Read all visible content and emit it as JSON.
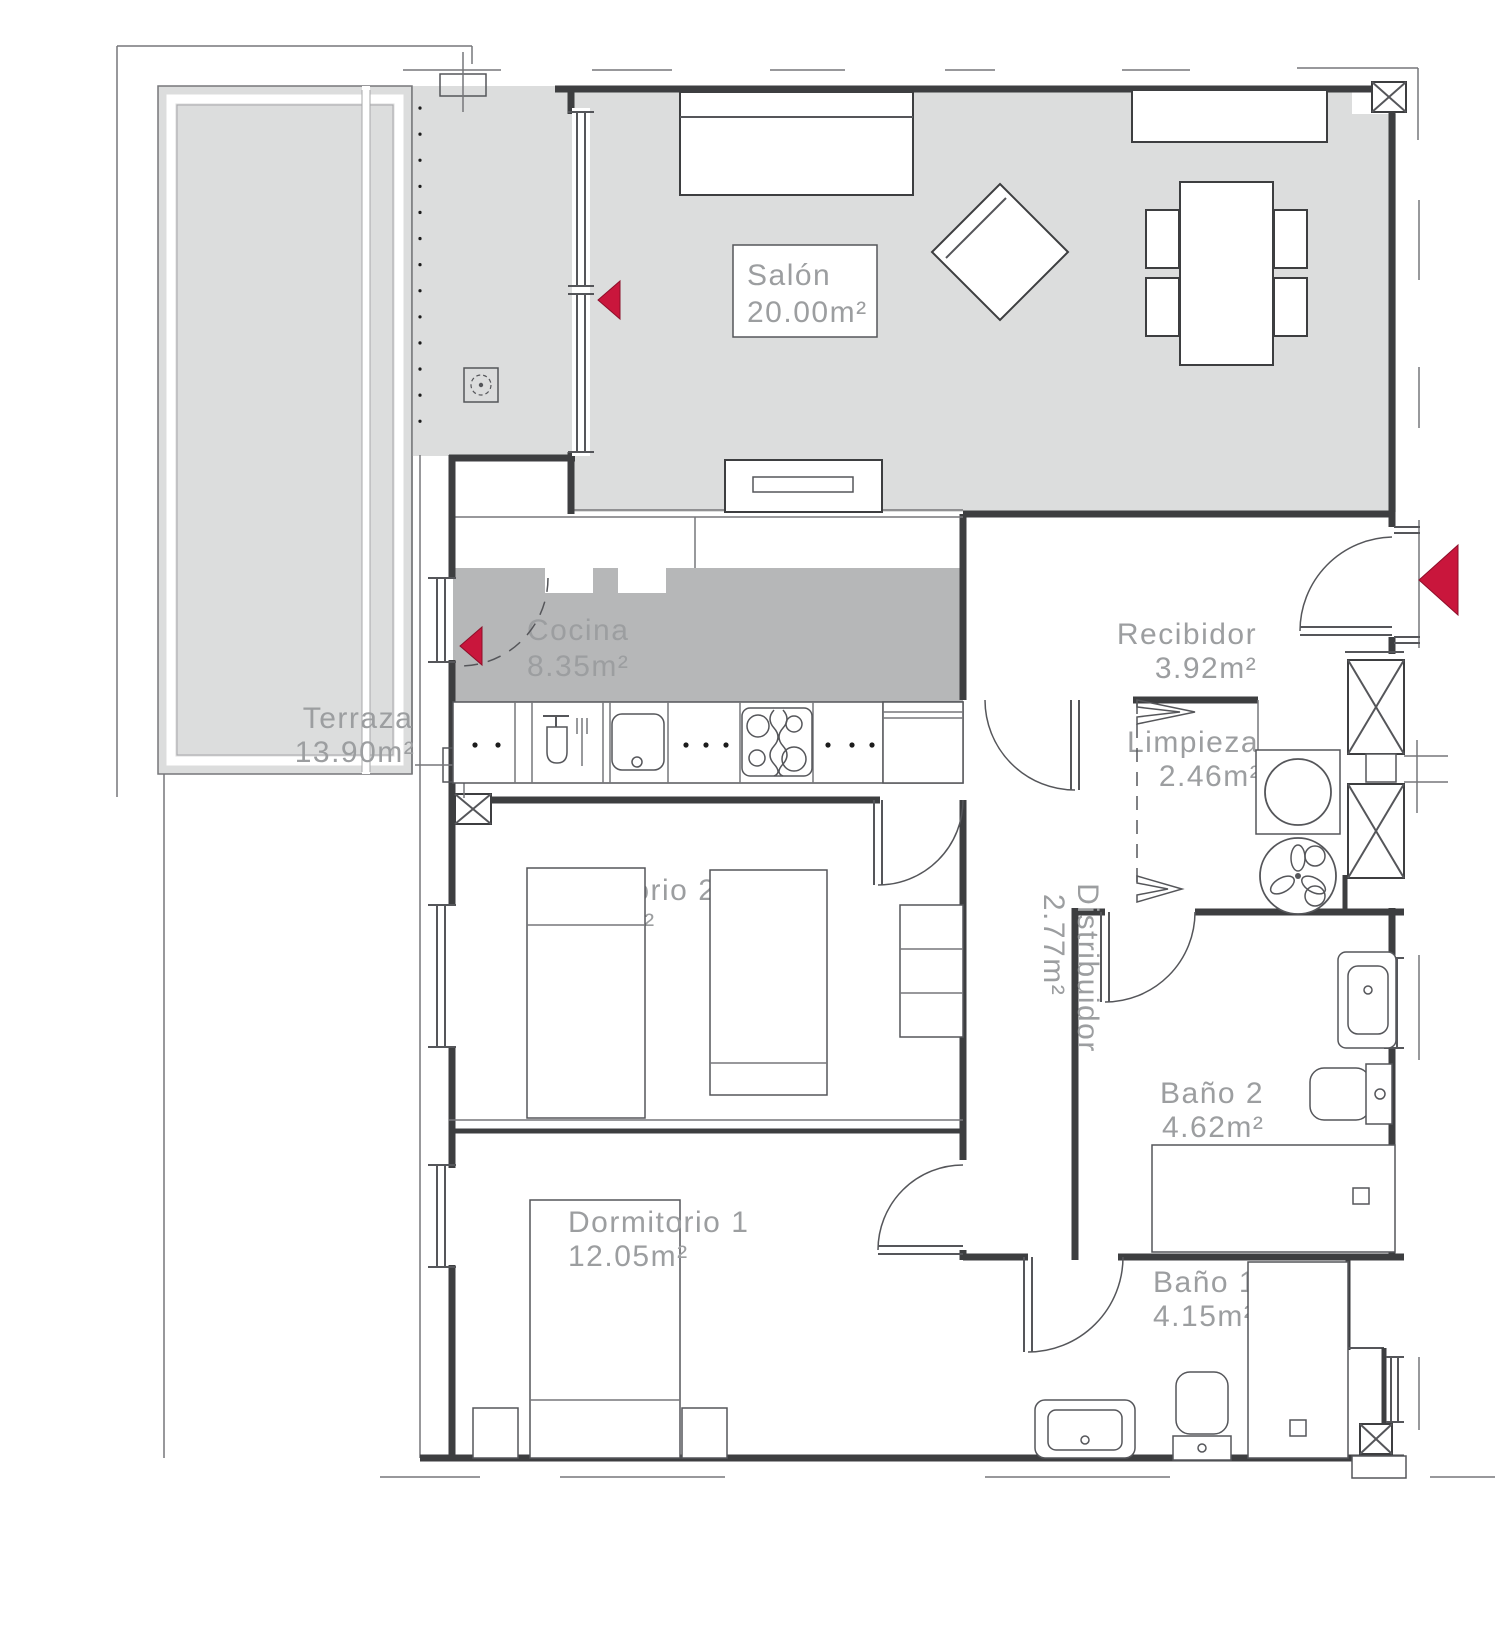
{
  "plan": {
    "type": "apartment-floor-plan",
    "language": "es"
  },
  "rooms": {
    "salon": {
      "name": "Salón",
      "area": "20.00m²"
    },
    "terraza": {
      "name": "Terraza",
      "area": "13.90m²"
    },
    "cocina": {
      "name": "Cocina",
      "area": "8.35m²"
    },
    "recibidor": {
      "name": "Recibidor",
      "area": "3.92m²"
    },
    "limpieza": {
      "name": "Limpieza",
      "area": "2.46m²"
    },
    "distribuidor": {
      "name": "Distribuidor",
      "area": "2.77m²"
    },
    "dormitorio2": {
      "name": "Dormitorio 2",
      "area": "10.00m²"
    },
    "dormitorio1": {
      "name": "Dormitorio 1",
      "area": "12.05m²"
    },
    "bano2": {
      "name": "Baño 2",
      "area": "4.62m²"
    },
    "bano1": {
      "name": "Baño 1",
      "area": "4.15m²"
    }
  },
  "colors": {
    "floor_light": "#dcdddd",
    "floor_dark": "#b6b7b8",
    "wall": "#3d3e40",
    "label_text": "#9c9ea0",
    "accent_red": "#c9163c"
  },
  "symbols": [
    "sofa",
    "armchair",
    "dining-table",
    "dining-chair",
    "sideboard",
    "tv-unit",
    "bar-stool",
    "dishwasher",
    "kitchen-sink",
    "hob",
    "fridge",
    "bed",
    "nightstand",
    "wardrobe",
    "shelving",
    "washing-machine",
    "water-heater-fan",
    "washbasin",
    "toilet",
    "shower-tray",
    "floor-drain",
    "vent-duct",
    "entrance-arrow-icon",
    "window-arrow-icon",
    "door-swing",
    "folding-door"
  ]
}
